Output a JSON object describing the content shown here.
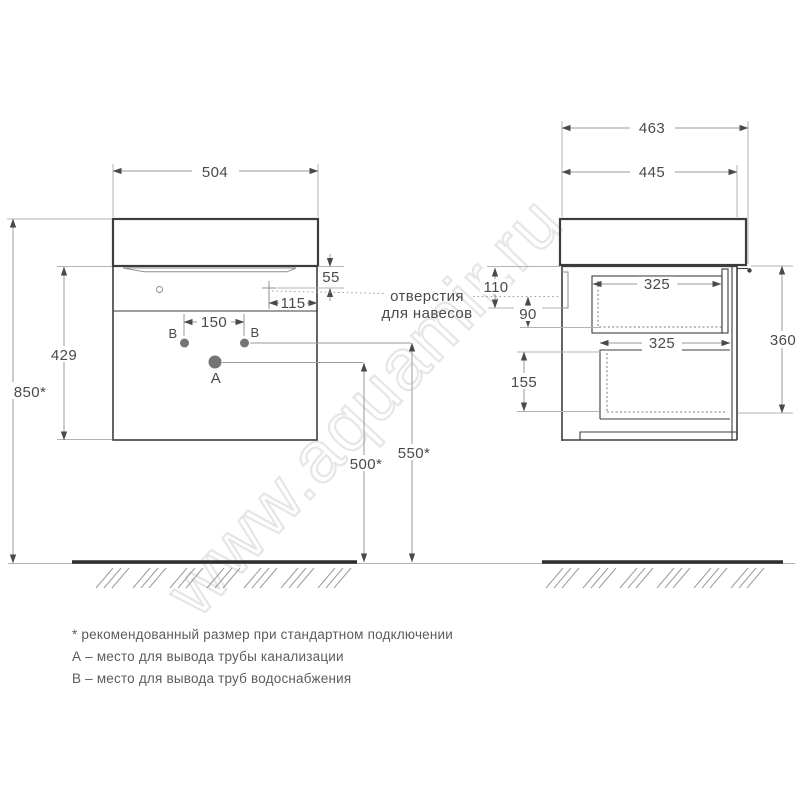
{
  "colors": {
    "lineDark": "#3d3d3d",
    "lineDim": "#9a9a9a",
    "lineExt": "#b3b3b3",
    "text": "#4a4a4a",
    "watermark": "#e5e5e5",
    "holeFill": "#757575",
    "ground": "#2e2e2e"
  },
  "watermark": {
    "text": "www.aquamir.ru"
  },
  "note": {
    "line1": "отверстия",
    "line2": "для навесов"
  },
  "front_view": {
    "width": "504",
    "body_height": "429",
    "mount_height": "850*",
    "hanger_v": "55",
    "hanger_h": "115",
    "b_spacing": "150",
    "drain_h": "500*",
    "supply_h": "550*",
    "label_a": "A",
    "label_b_left": "B",
    "label_b_right": "B"
  },
  "side_view": {
    "depth_total": "463",
    "depth_body": "445",
    "dim_110": "110",
    "dim_90": "90",
    "dim_155": "155",
    "dim_360": "360",
    "drawer_depth_top": "325",
    "drawer_depth_bottom": "325"
  },
  "footnotes": {
    "line1": "* рекомендованный размер при стандартном подключении",
    "line2": "А – место для вывода трубы канализации",
    "line3": "В – место для вывода труб водоснабжения"
  }
}
